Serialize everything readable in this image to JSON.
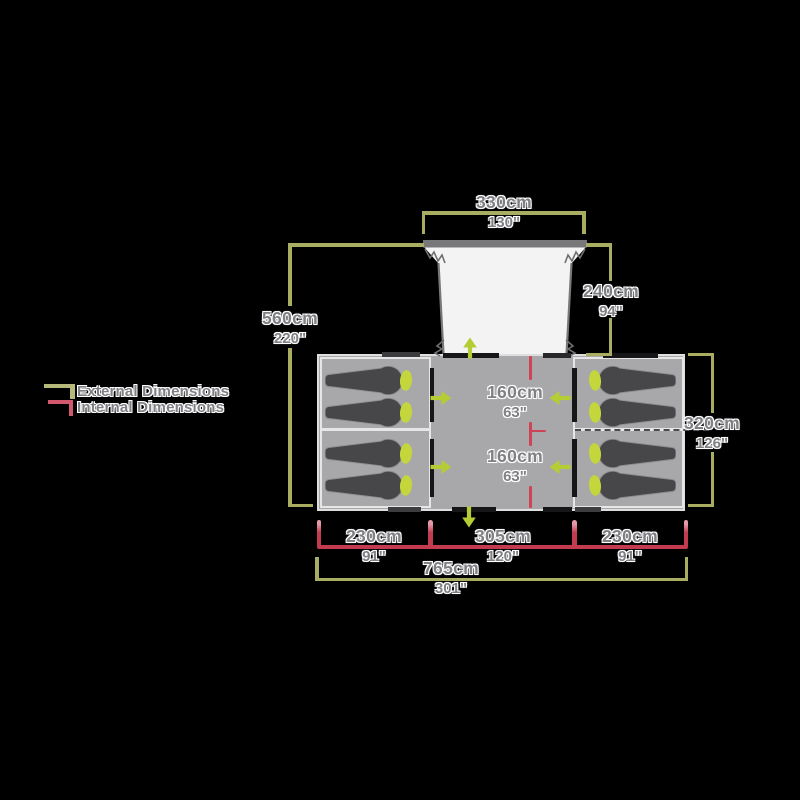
{
  "legend": {
    "external_label": "External Dimensions",
    "internal_label": "Internal Dimensions"
  },
  "dimensions": {
    "top_width": {
      "cm": "330cm",
      "inch": "130\""
    },
    "total_depth": {
      "cm": "560cm",
      "inch": "220\""
    },
    "porch_depth": {
      "cm": "240cm",
      "inch": "94\""
    },
    "body_depth": {
      "cm": "320cm",
      "inch": "126\""
    },
    "inner_front": {
      "cm": "160cm",
      "inch": "63\""
    },
    "inner_back": {
      "cm": "160cm",
      "inch": "63\""
    },
    "pod_left_width": {
      "cm": "230cm",
      "inch": "91\""
    },
    "center_width": {
      "cm": "305cm",
      "inch": "120\""
    },
    "pod_right_width": {
      "cm": "230cm",
      "inch": "91\""
    },
    "total_width": {
      "cm": "765cm",
      "inch": "301\""
    }
  },
  "colors": {
    "external_dimension": "#a9ad62",
    "internal_dimension": "#c23b4f",
    "door_arrow": "#b5cc35",
    "pillow": "#c3d63b",
    "tent_body": "#a8a8ab",
    "sleeping_bag": "#47474a",
    "canopy": "#f3f3f3",
    "label_text": "#7f8084"
  },
  "icons": {
    "door_arrows": [
      "right",
      "right",
      "left",
      "left",
      "up",
      "down"
    ],
    "sleeping_bags_left_pod": 4,
    "sleeping_bags_right_pod": 4
  }
}
